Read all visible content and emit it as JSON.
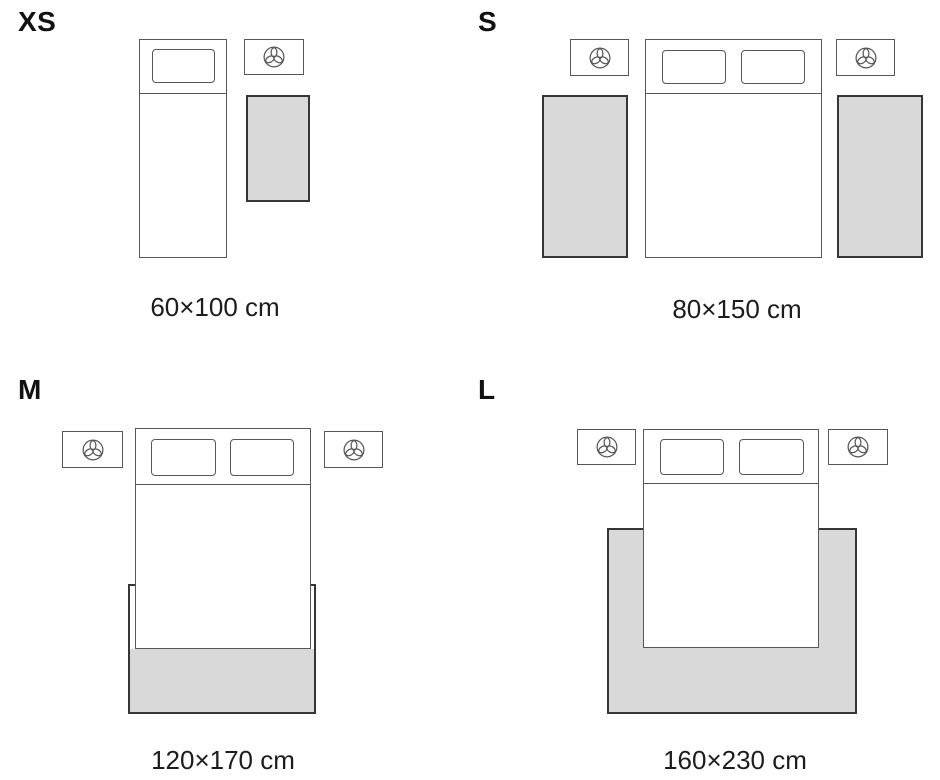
{
  "guide": {
    "background": "#ffffff",
    "colors": {
      "rug_fill": "#d9d9d9",
      "rug_outline": "#363636",
      "furniture_outline": "#575757",
      "label_text": "#111111",
      "caption_text": "#1c1c1c"
    },
    "icons": {
      "nightstand_lamp": "trefoil-lamp-icon"
    }
  },
  "sizes": [
    {
      "id": "xs",
      "label": "XS",
      "caption": "60×100 cm",
      "bed_type": "single",
      "rug_count": 1,
      "rug_placement": "beside bed"
    },
    {
      "id": "s",
      "label": "S",
      "caption": "80×150 cm",
      "bed_type": "double",
      "rug_count": 2,
      "rug_placement": "both sides of bed"
    },
    {
      "id": "m",
      "label": "M",
      "caption": "120×170 cm",
      "bed_type": "double",
      "rug_count": 1,
      "rug_placement": "under lower half of bed"
    },
    {
      "id": "l",
      "label": "L",
      "caption": "160×230 cm",
      "bed_type": "double",
      "rug_count": 1,
      "rug_placement": "under bed, extending on three sides"
    }
  ]
}
